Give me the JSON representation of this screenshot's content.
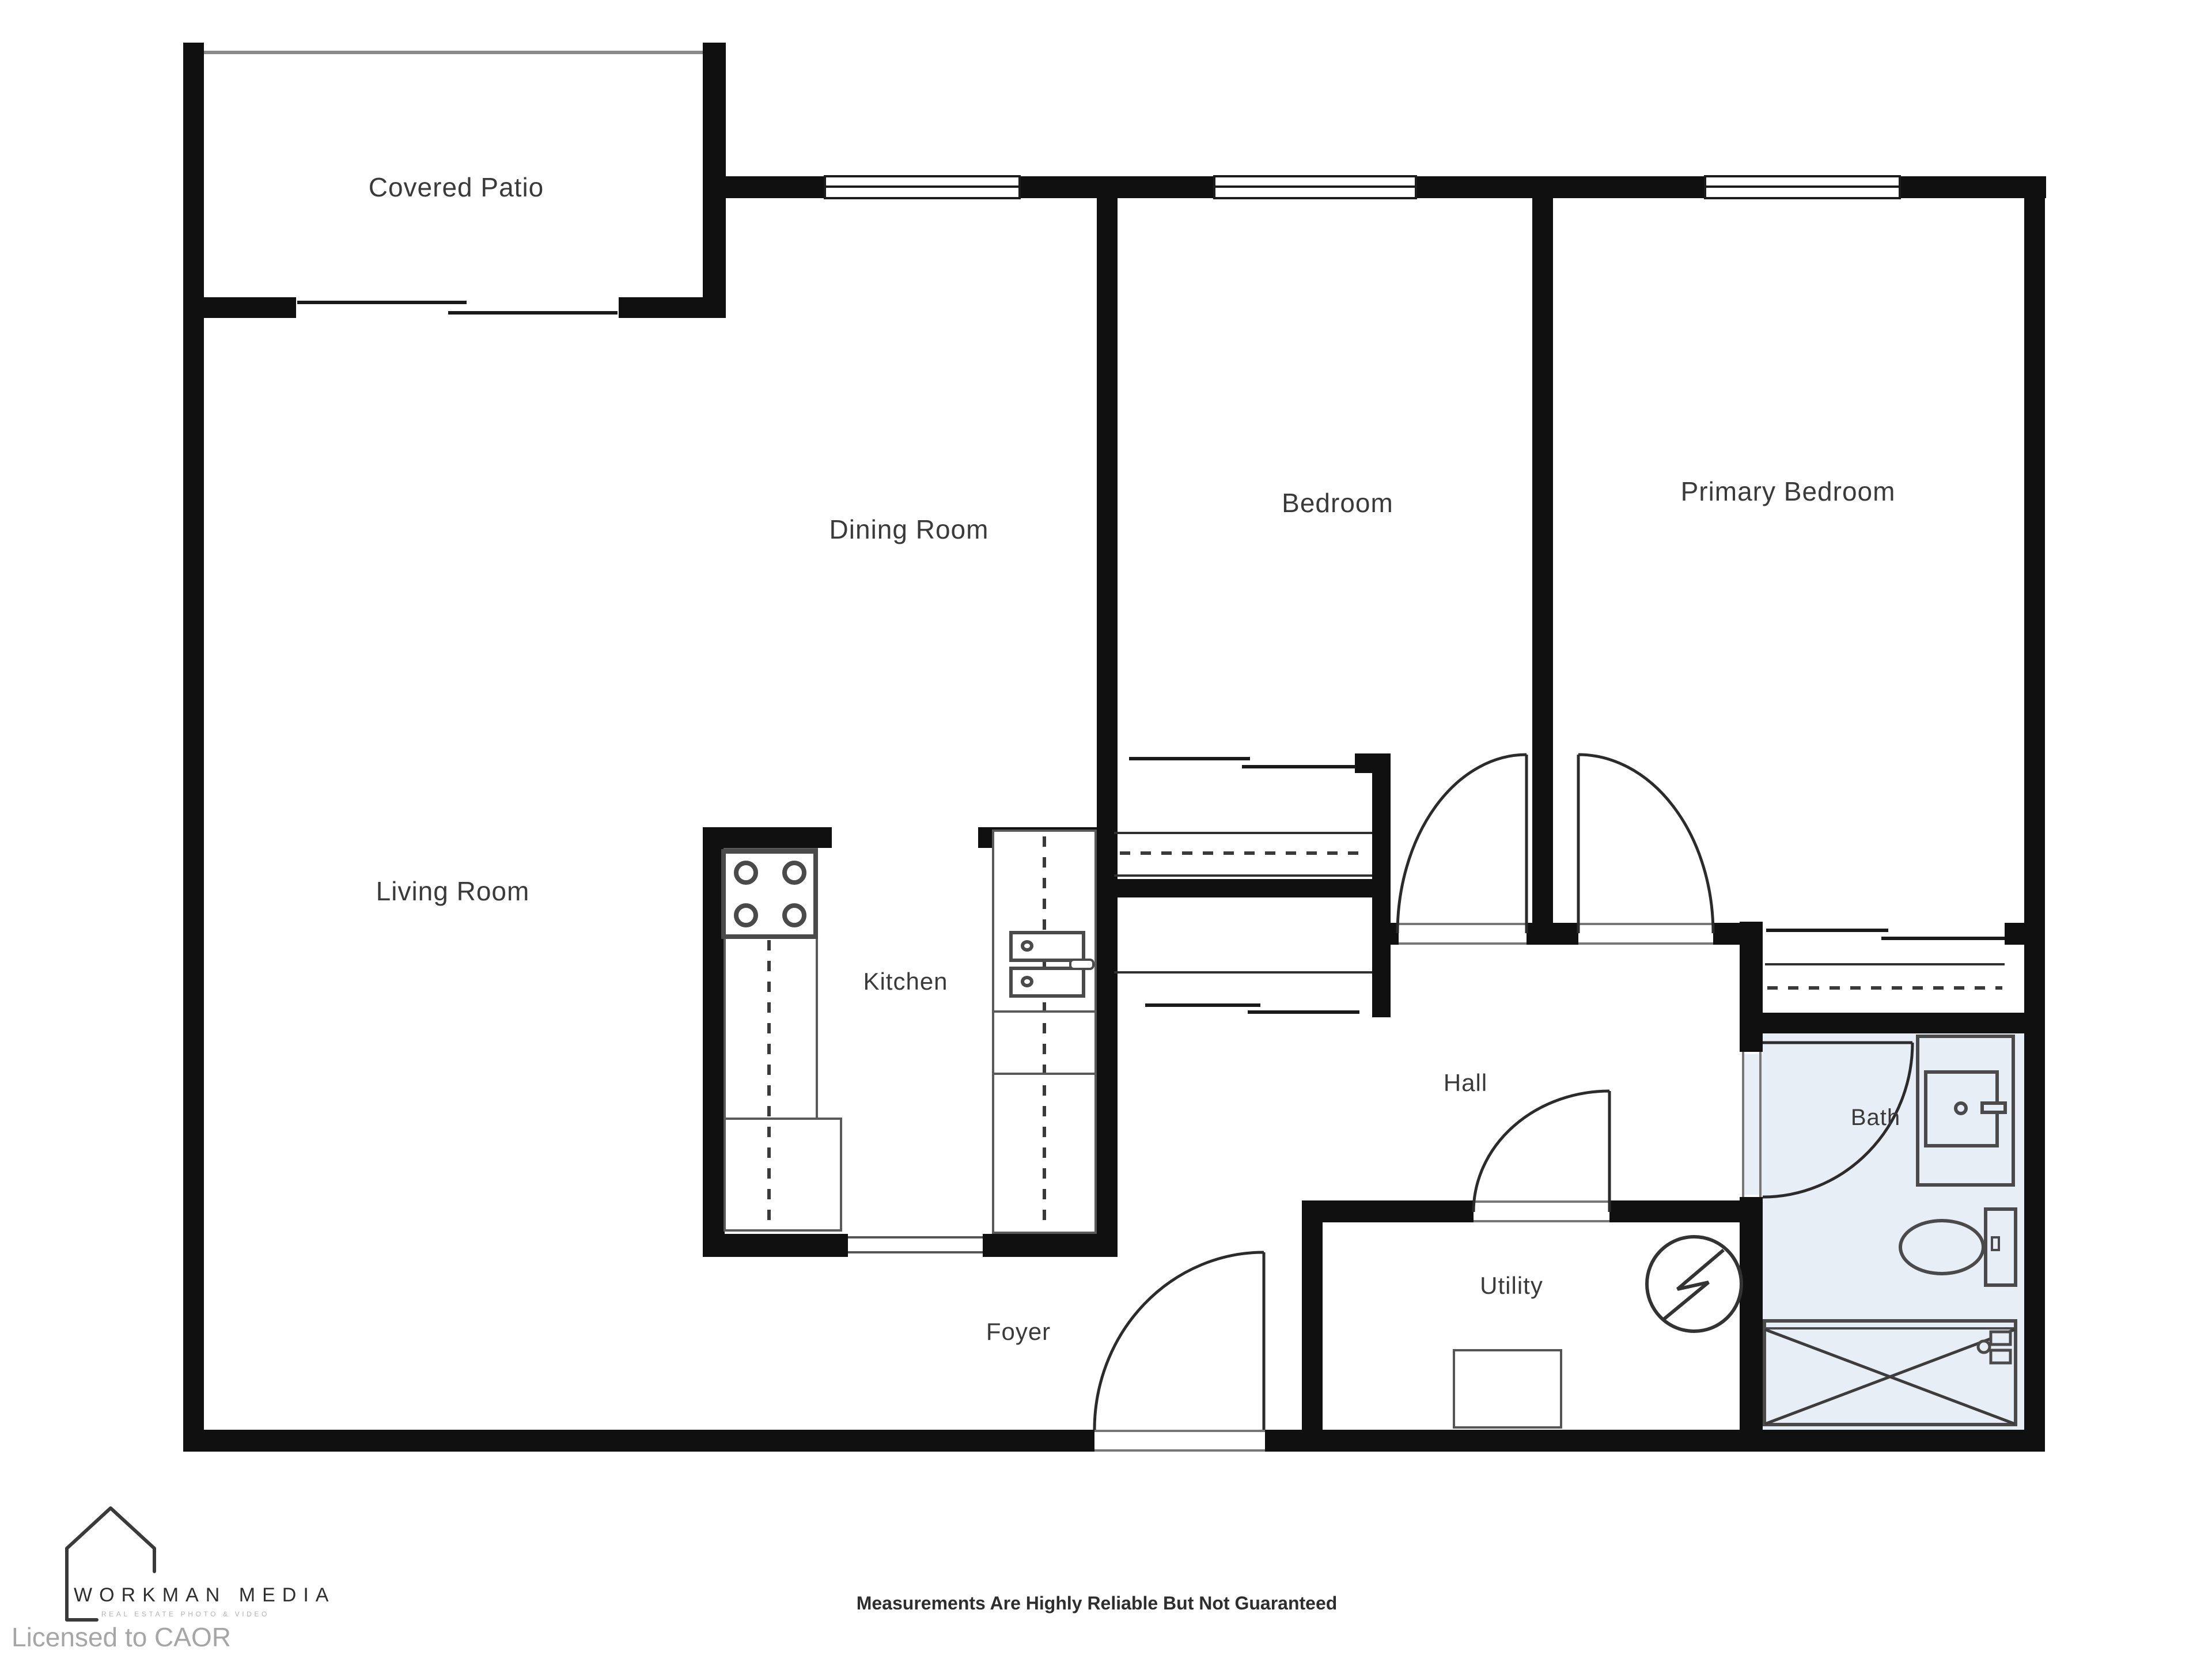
{
  "rooms": {
    "covered_patio": {
      "label": "Covered Patio"
    },
    "dining_room": {
      "label": "Dining Room"
    },
    "bedroom": {
      "label": "Bedroom"
    },
    "primary_bedroom": {
      "label": "Primary Bedroom"
    },
    "living_room": {
      "label": "Living Room"
    },
    "kitchen": {
      "label": "Kitchen"
    },
    "hall": {
      "label": "Hall"
    },
    "utility": {
      "label": "Utility"
    },
    "bath": {
      "label": "Bath"
    },
    "foyer": {
      "label": "Foyer"
    }
  },
  "footer": {
    "logo_title": "WORKMAN MEDIA",
    "logo_tagline": "REAL ESTATE PHOTO & VIDEO",
    "disclaimer": "Measurements Are Highly Reliable But Not Guaranteed",
    "license": "Licensed to CAOR"
  },
  "colors": {
    "wall": "#101010",
    "bath_fill": "#e8eef5",
    "fixture_line": "#4a4a4a",
    "label_text": "#3a3a3a",
    "logo_text": "#2e2e2e",
    "license_text": "#a6a6a6"
  },
  "icons": {
    "stove": "stove-icon",
    "kitchen_sink": "kitchen-sink-icon",
    "vanity_sink": "vanity-sink-icon",
    "toilet": "toilet-icon",
    "bathtub": "bathtub-icon",
    "electrical_panel": "electrical-panel-icon",
    "water_heater": "water-heater-icon",
    "house_logo": "house-logo-icon"
  }
}
